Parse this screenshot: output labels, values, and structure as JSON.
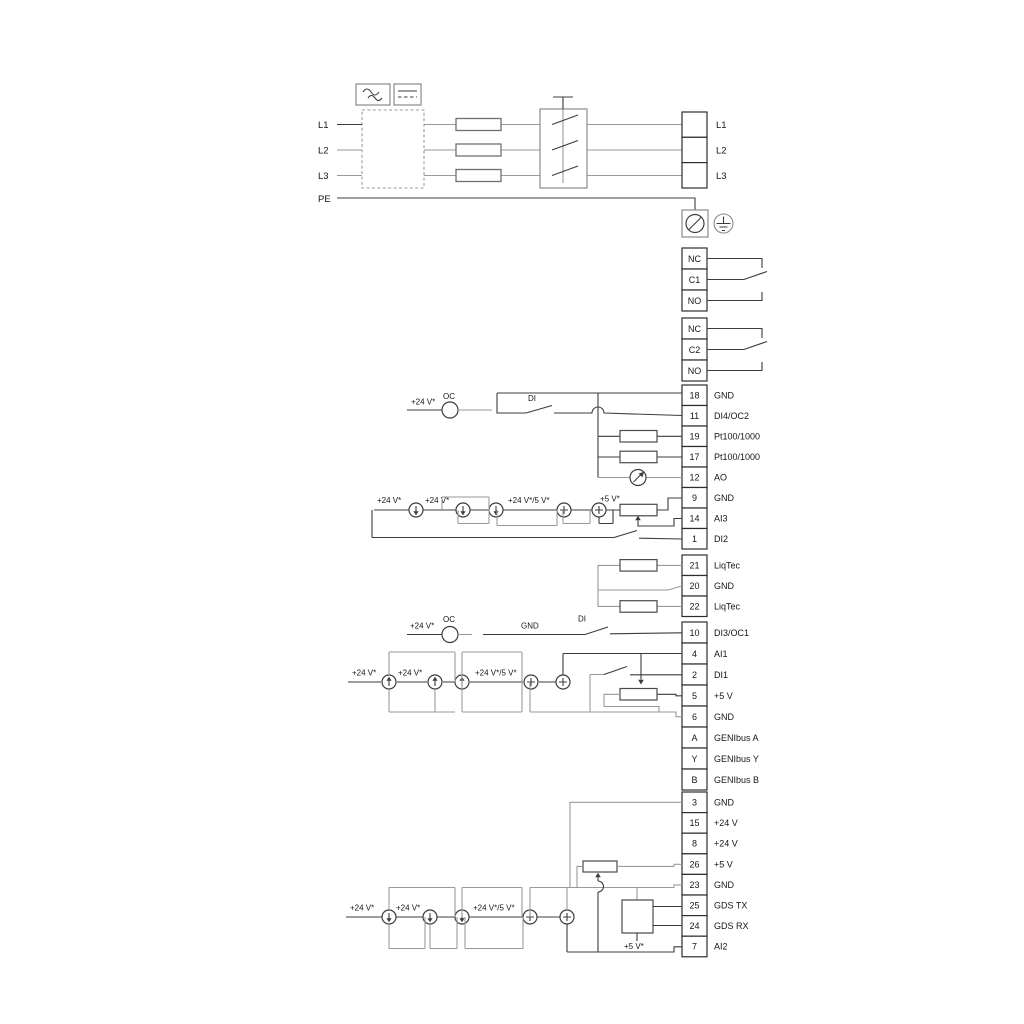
{
  "power": {
    "inputs": [
      "L1",
      "L2",
      "L3",
      "PE"
    ],
    "outputs": [
      "L1",
      "L2",
      "L3"
    ]
  },
  "relay1": {
    "terminals": [
      "NC",
      "C1",
      "NO"
    ]
  },
  "relay2": {
    "terminals": [
      "NC",
      "C2",
      "NO"
    ]
  },
  "strip1": [
    {
      "num": "18",
      "label": "GND"
    },
    {
      "num": "11",
      "label": "DI4/OC2"
    },
    {
      "num": "19",
      "label": "Pt100/1000"
    },
    {
      "num": "17",
      "label": "Pt100/1000"
    },
    {
      "num": "12",
      "label": "AO"
    },
    {
      "num": "9",
      "label": "GND"
    },
    {
      "num": "14",
      "label": "AI3"
    },
    {
      "num": "1",
      "label": "DI2"
    }
  ],
  "liqtec": [
    {
      "num": "21",
      "label": "LiqTec"
    },
    {
      "num": "20",
      "label": "GND"
    },
    {
      "num": "22",
      "label": "LiqTec"
    }
  ],
  "strip2": [
    {
      "num": "10",
      "label": "DI3/OC1"
    },
    {
      "num": "4",
      "label": "AI1"
    },
    {
      "num": "2",
      "label": "DI1"
    },
    {
      "num": "5",
      "label": "+5 V"
    },
    {
      "num": "6",
      "label": "GND"
    },
    {
      "num": "A",
      "label": "GENIbus A"
    },
    {
      "num": "Y",
      "label": "GENIbus Y"
    },
    {
      "num": "B",
      "label": "GENIbus B"
    }
  ],
  "strip3": [
    {
      "num": "3",
      "label": "GND"
    },
    {
      "num": "15",
      "label": "+24 V"
    },
    {
      "num": "8",
      "label": "+24 V"
    },
    {
      "num": "26",
      "label": "+5 V"
    },
    {
      "num": "23",
      "label": "GND"
    },
    {
      "num": "25",
      "label": "GDS TX"
    },
    {
      "num": "24",
      "label": "GDS RX"
    },
    {
      "num": "7",
      "label": "AI2"
    }
  ],
  "ann": {
    "v24": "+24 V*",
    "v24_5": "+24 V*/5 V*",
    "v5": "+5 V*",
    "oc": "OC",
    "di": "DI",
    "gnd": "GND"
  },
  "icons": {
    "ac-symbol": "sine-wave",
    "dc-symbol": "solid-over-dashed-line",
    "earth-symbol": "protective-earth",
    "ground-screw": "circle-with-slash",
    "current-source": "circle-with-arrow",
    "voltage-source": "circle-with-plus",
    "analog-output-meter": "circle-with-needle"
  },
  "colors": {
    "wire_gray": "#9a9a9a",
    "wire_dark": "#3c3c3c",
    "terminal_border": "#2d2d2d",
    "background": "#ffffff"
  }
}
